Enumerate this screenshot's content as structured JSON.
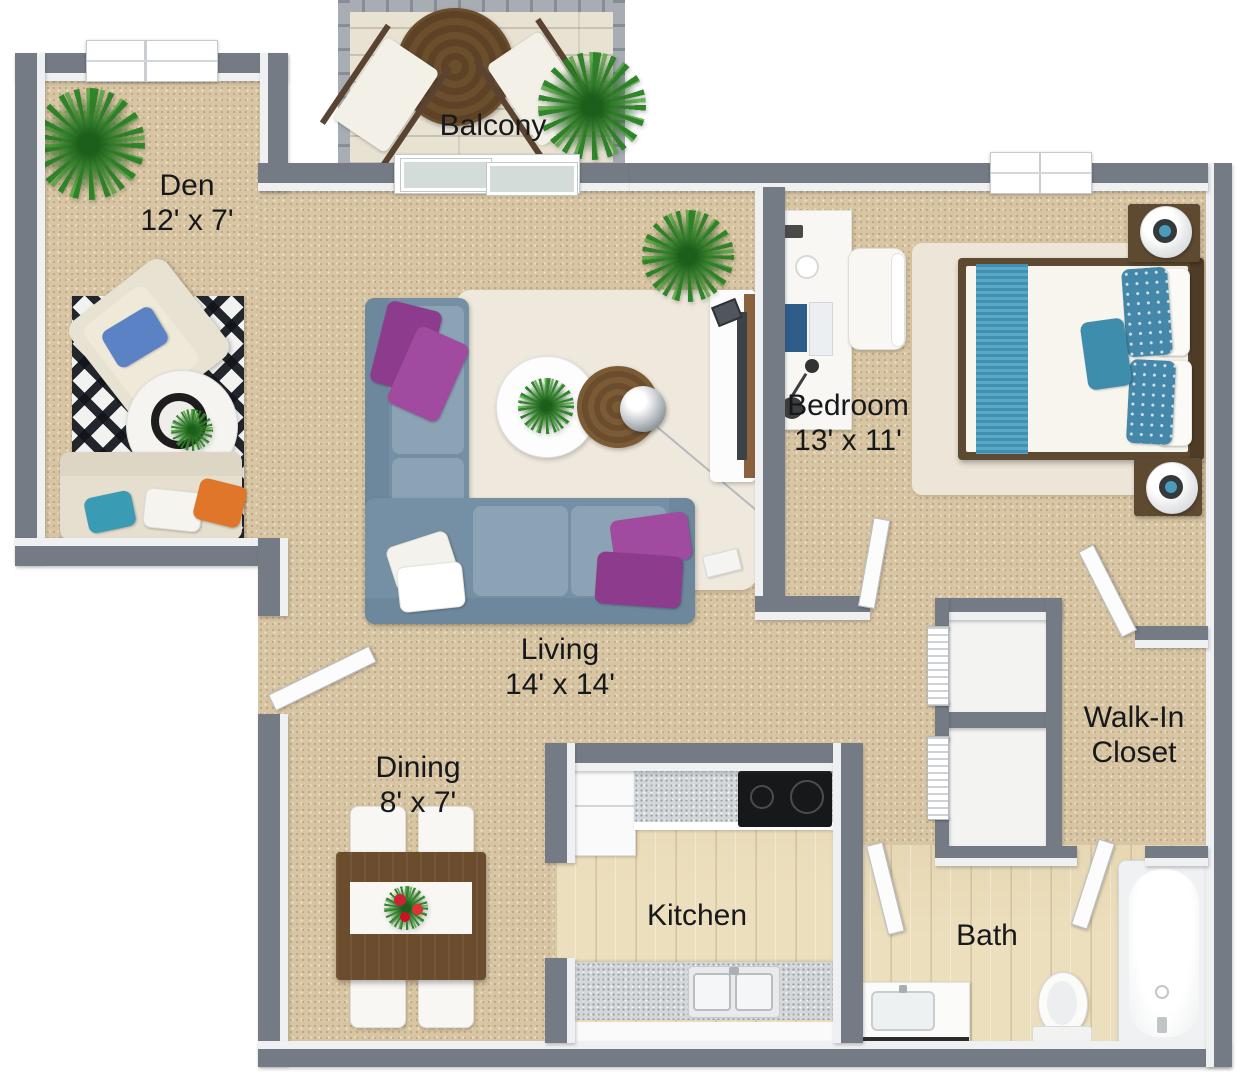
{
  "rooms": {
    "den": {
      "label": "Den",
      "dims": "12' x 7'"
    },
    "balcony": {
      "label": "Balcony"
    },
    "bedroom": {
      "label": "Bedroom",
      "dims": "13' x 11'"
    },
    "living": {
      "label": "Living",
      "dims": "14' x 14'"
    },
    "dining": {
      "label": "Dining",
      "dims": "8' x 7'"
    },
    "kitchen": {
      "label": "Kitchen"
    },
    "bath": {
      "label": "Bath"
    },
    "walk_in_closet": {
      "label": "Walk-In Closet"
    }
  },
  "furniture": {
    "den": [
      "potted-plant",
      "armchair-with-blue-pillow",
      "black-white-ikat-rug",
      "round-coffee-table",
      "loveseat-with-pillows"
    ],
    "balcony": [
      "railing",
      "round-bistro-table",
      "two-deck-chairs",
      "potted-plant",
      "sliding-glass-door"
    ],
    "living": [
      "l-shaped-sectional-sofa",
      "purple-pillows",
      "white-pillows",
      "shag-rug",
      "round-white-coffee-table",
      "round-wood-side-table",
      "arc-floor-lamp",
      "tv-console",
      "potted-plant",
      "speaker"
    ],
    "bedroom": [
      "queen-bed-teal-bedding",
      "two-nightstands",
      "two-sphere-lamps",
      "area-rug",
      "desk-with-laptop",
      "desk-chair",
      "window"
    ],
    "dining": [
      "wood-dining-table",
      "table-runner-with-flowers",
      "four-white-chairs"
    ],
    "kitchen": [
      "refrigerator",
      "granite-counters",
      "cooktop",
      "double-sink",
      "white-cabinets"
    ],
    "bath": [
      "vanity-with-sink",
      "toilet",
      "bathtub"
    ],
    "closets": [
      "two-linen-closets-bifold-doors",
      "walk-in-closet-door"
    ]
  },
  "colors": {
    "wall_gray": "#757b84",
    "wall_face_white": "#eef0f2",
    "carpet_tan": "#d8c5a3",
    "wood_floor": "#ecdfbd",
    "balcony_wood": "#e8e2d3",
    "sofa_blue_gray": "#7590a4",
    "pillow_purple": "#8d3b8d",
    "bed_teal": "#4a9cba",
    "pillow_orange": "#e0762a",
    "pillow_blue": "#5b82c4",
    "dark_wood": "#5e4a31",
    "rug_cream": "#efe8dc",
    "plant_green": "#2c7826"
  }
}
